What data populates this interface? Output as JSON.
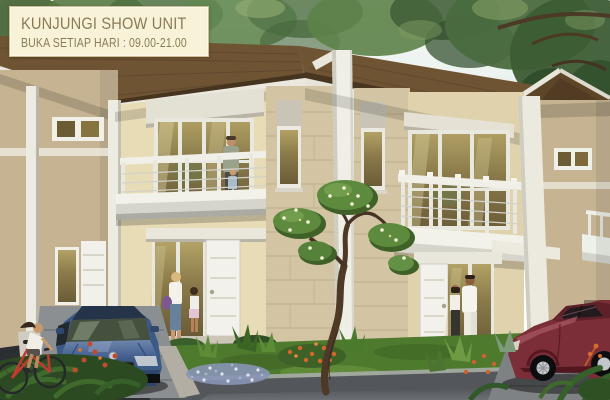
{
  "banner": {
    "title": "KUNJUNGI SHOW UNIT",
    "subtitle": "BUKA SETIAP HARI : 09.00-21.00",
    "background_color": "#f8f3d8",
    "border_color": "#cbbf96",
    "text_color": "#8a7b58"
  },
  "scene": {
    "vehicles": {
      "blue_car_plate": "B 1883 B",
      "blue_car_color": "#3d5a87",
      "red_car_color": "#7c2e38",
      "bicycle_color": "#c03a2e"
    },
    "palette": {
      "sky": "#edf3f1",
      "foliage": "#53713f",
      "roof": "#6f5433",
      "roof_dark": "#5d4527",
      "wall_cream": "#e8dcb6",
      "wall_tan": "#c6b392",
      "stone": "#d3c5a4",
      "trim_white": "#efeee5",
      "glass_amber": "#8a7a4e",
      "grass": "#4e7a2e",
      "road": "#53575b",
      "driveway": "#8b8f92"
    }
  }
}
